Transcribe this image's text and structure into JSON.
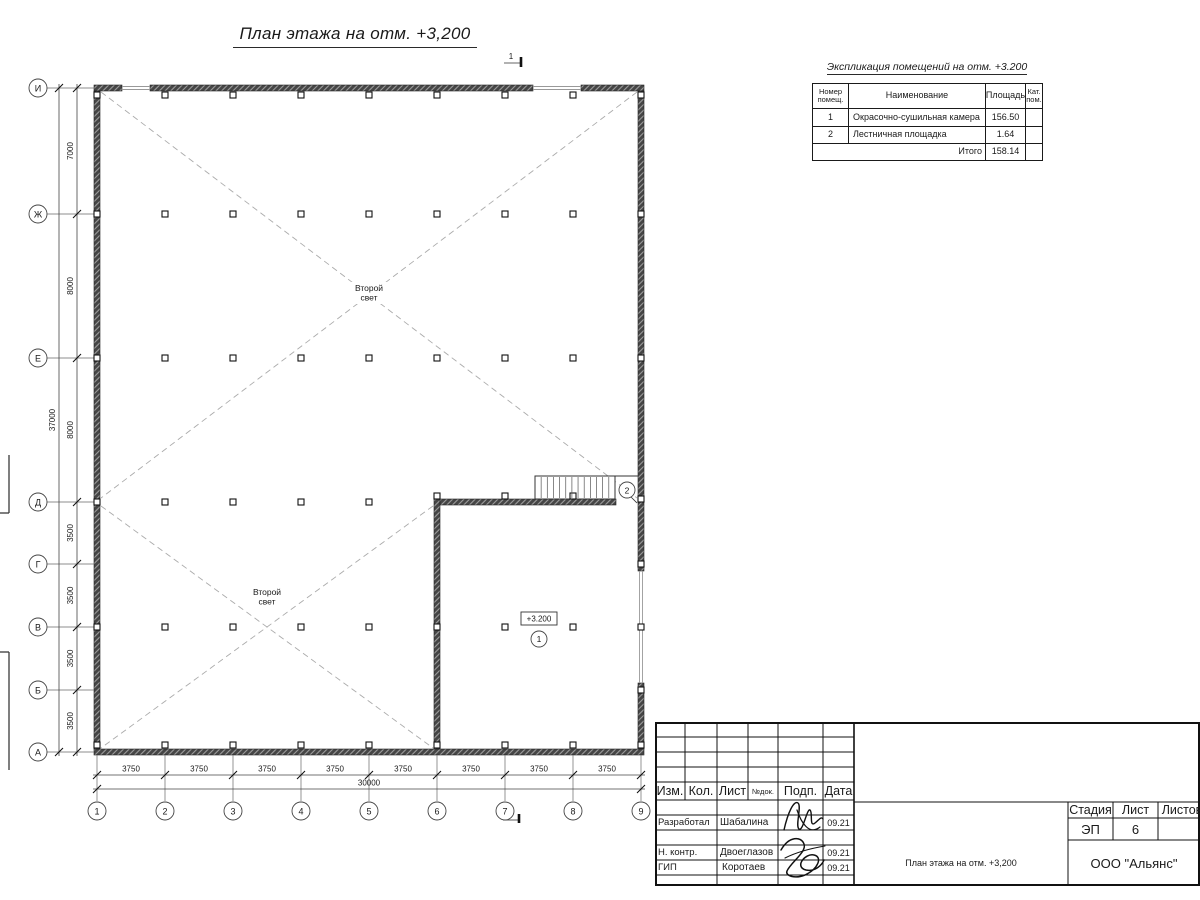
{
  "drawing_title": "План этажа на отм. +3,200",
  "section_mark_label": "1",
  "colors": {
    "line": "#1a1a1a",
    "wall_fill": "#454545",
    "dash": "#ababab"
  },
  "axes": {
    "horizontal": [
      "1",
      "2",
      "3",
      "4",
      "5",
      "6",
      "7",
      "8",
      "9"
    ],
    "vertical": [
      "И",
      "Ж",
      "Е",
      "Д",
      "Г",
      "В",
      "Б",
      "А"
    ]
  },
  "dimensions": {
    "bottom_bays": [
      "3750",
      "3750",
      "3750",
      "3750",
      "3750",
      "3750",
      "3750",
      "3750"
    ],
    "bottom_total": "30000",
    "left_bays": [
      "7000",
      "8000",
      "8000",
      "3500",
      "3500",
      "3500",
      "3500"
    ],
    "left_total": "37000"
  },
  "plan_labels": {
    "second_light": "Второй свет",
    "elevation": "+3.200",
    "room1": "1",
    "room2": "2"
  },
  "explication": {
    "title": "Экспликация помещений на отм. +3.200",
    "col_num": "Номер помещ.",
    "col_name": "Наименование",
    "col_area": "Площадь",
    "col_cat": "Кат. пом.",
    "rows": [
      {
        "num": "1",
        "name": "Окрасочно-сушильная камера",
        "area": "156.50",
        "cat": ""
      },
      {
        "num": "2",
        "name": "Лестничная площадка",
        "area": "1.64",
        "cat": ""
      }
    ],
    "total_label": "Итого",
    "total_area": "158.14"
  },
  "title_block": {
    "cols": {
      "izm": "Изм.",
      "kol": "Кол.",
      "list": "Лист",
      "ndok": "№док.",
      "podp": "Подп.",
      "data": "Дата"
    },
    "people": [
      {
        "role": "Разработал",
        "name": "Шабалина",
        "date": "09.21"
      },
      {
        "role": "Н. контр.",
        "name": "Двоеглазов",
        "date": "09.21"
      },
      {
        "role": "ГИП",
        "name": "Коротаев",
        "date": "09.21"
      }
    ],
    "stage_label": "Стадия",
    "sheet_label": "Лист",
    "sheets_label": "Листов",
    "stage": "ЭП",
    "sheet_num": "6",
    "sheets_total": "",
    "doc_name": "План этажа на отм. +3,200",
    "company": "ООО \"Альянс\""
  }
}
